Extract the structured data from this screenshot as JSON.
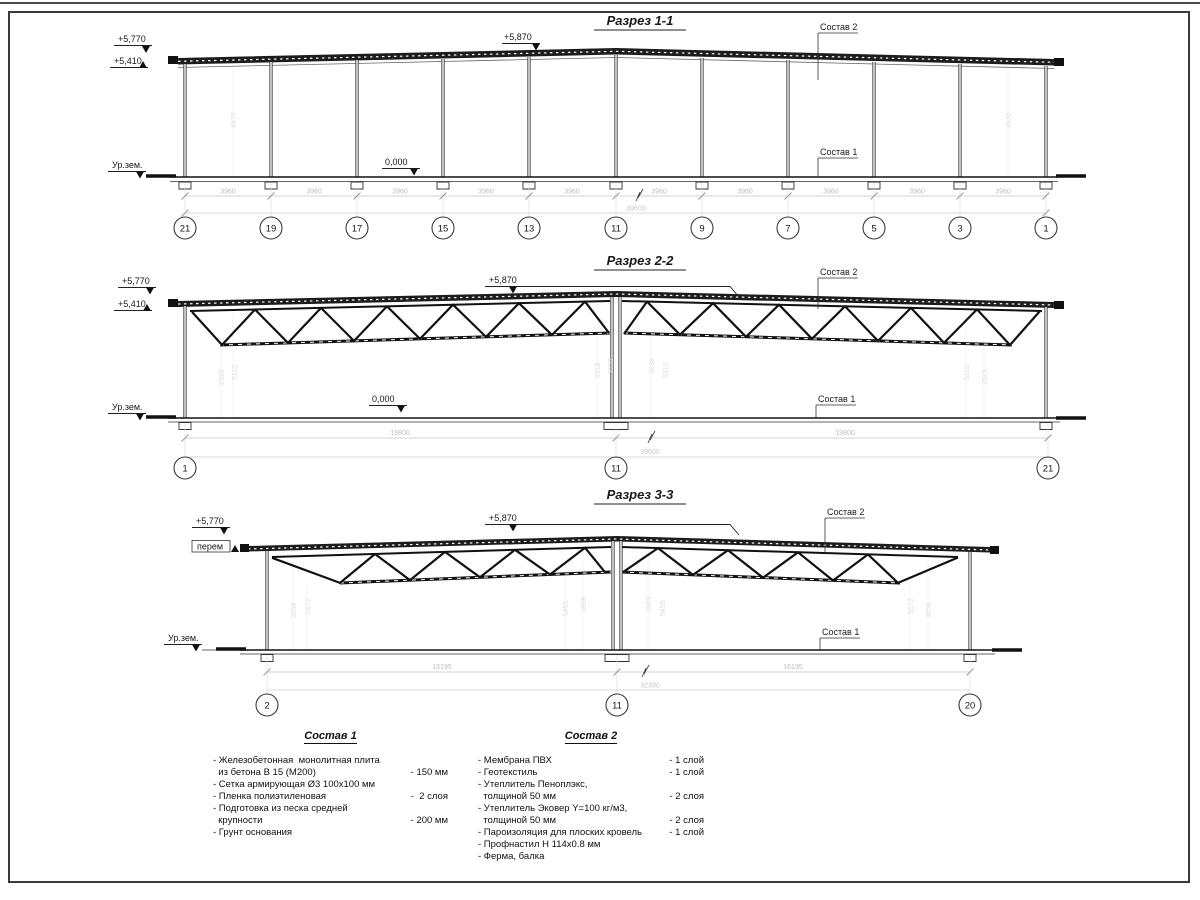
{
  "sections": {
    "s1": {
      "title": "Разрез 1-1",
      "elev_top": "+5,770",
      "elev_low": "+5,410",
      "elev_peak": "+5,870",
      "ground": "Ур.зем.",
      "zero": "0,000",
      "layer2": "Состав 2",
      "layer1": "Состав 1",
      "bay_dim": "3960",
      "total_dim": "39600",
      "bubbles": [
        "21",
        "19",
        "17",
        "15",
        "13",
        "11",
        "9",
        "7",
        "5",
        "3",
        "1"
      ],
      "vdims": [
        "4970",
        "4930"
      ]
    },
    "s2": {
      "title": "Разрез 2-2",
      "elev_top": "+5,770",
      "elev_low": "+5,410",
      "elev_peak": "+5,870",
      "ground": "Ур.зем.",
      "zero": "0,000",
      "layer2": "Состав 2",
      "layer1": "Состав 1",
      "span_dims": [
        "19800",
        "19800"
      ],
      "total_dim": "39600",
      "bubbles": [
        "1",
        "11",
        "21"
      ],
      "vdims": [
        "2529",
        "5110",
        "5315",
        "3638",
        "3638",
        "5315",
        "5110",
        "2529"
      ]
    },
    "s3": {
      "title": "Разрез 3-3",
      "elev_top": "+5,770",
      "elev_low": "перем",
      "elev_peak": "+5,870",
      "ground": "Ур.зем.",
      "layer2": "Состав 2",
      "layer1": "Состав 1",
      "span_dims": [
        "16195",
        "16195"
      ],
      "total_dim": "32390",
      "bubbles": [
        "2",
        "11",
        "20"
      ],
      "vdims": [
        "3059",
        "5172",
        "5455",
        "3909",
        "3909",
        "5455",
        "5172",
        "3059"
      ]
    }
  },
  "legend1": {
    "title": "Состав 1",
    "items": [
      {
        "t": "- Железобетонная  монолитная плита\n  из бетона В 15 (М200)",
        "v": "- 150 мм"
      },
      {
        "t": "- Сетка армирующая Ø3 100x100 мм",
        "v": ""
      },
      {
        "t": "- Пленка полиэтиленовая",
        "v": "-  2 слоя"
      },
      {
        "t": "- Подготовка из песка средней\n  крупности",
        "v": "- 200 мм"
      },
      {
        "t": "- Грунт основания",
        "v": ""
      }
    ]
  },
  "legend2": {
    "title": "Состав 2",
    "items": [
      {
        "t": "- Мембрана ПВХ",
        "v": "- 1 слой"
      },
      {
        "t": "- Геотекстиль",
        "v": "- 1 слой"
      },
      {
        "t": "- Утеплитель Пеноплэкс,\n  толщиной 50 мм",
        "v": "- 2 слоя"
      },
      {
        "t": "- Утеплитель Эковер Y=100 кг/м3,\n  толщиной 50 мм",
        "v": "- 2 слоя"
      },
      {
        "t": "- Пароизоляция для плоских кровель",
        "v": "- 1 слой"
      },
      {
        "t": "- Профнастил Н 114x0.8 мм",
        "v": ""
      },
      {
        "t": "- Ферма, балка",
        "v": ""
      }
    ]
  }
}
